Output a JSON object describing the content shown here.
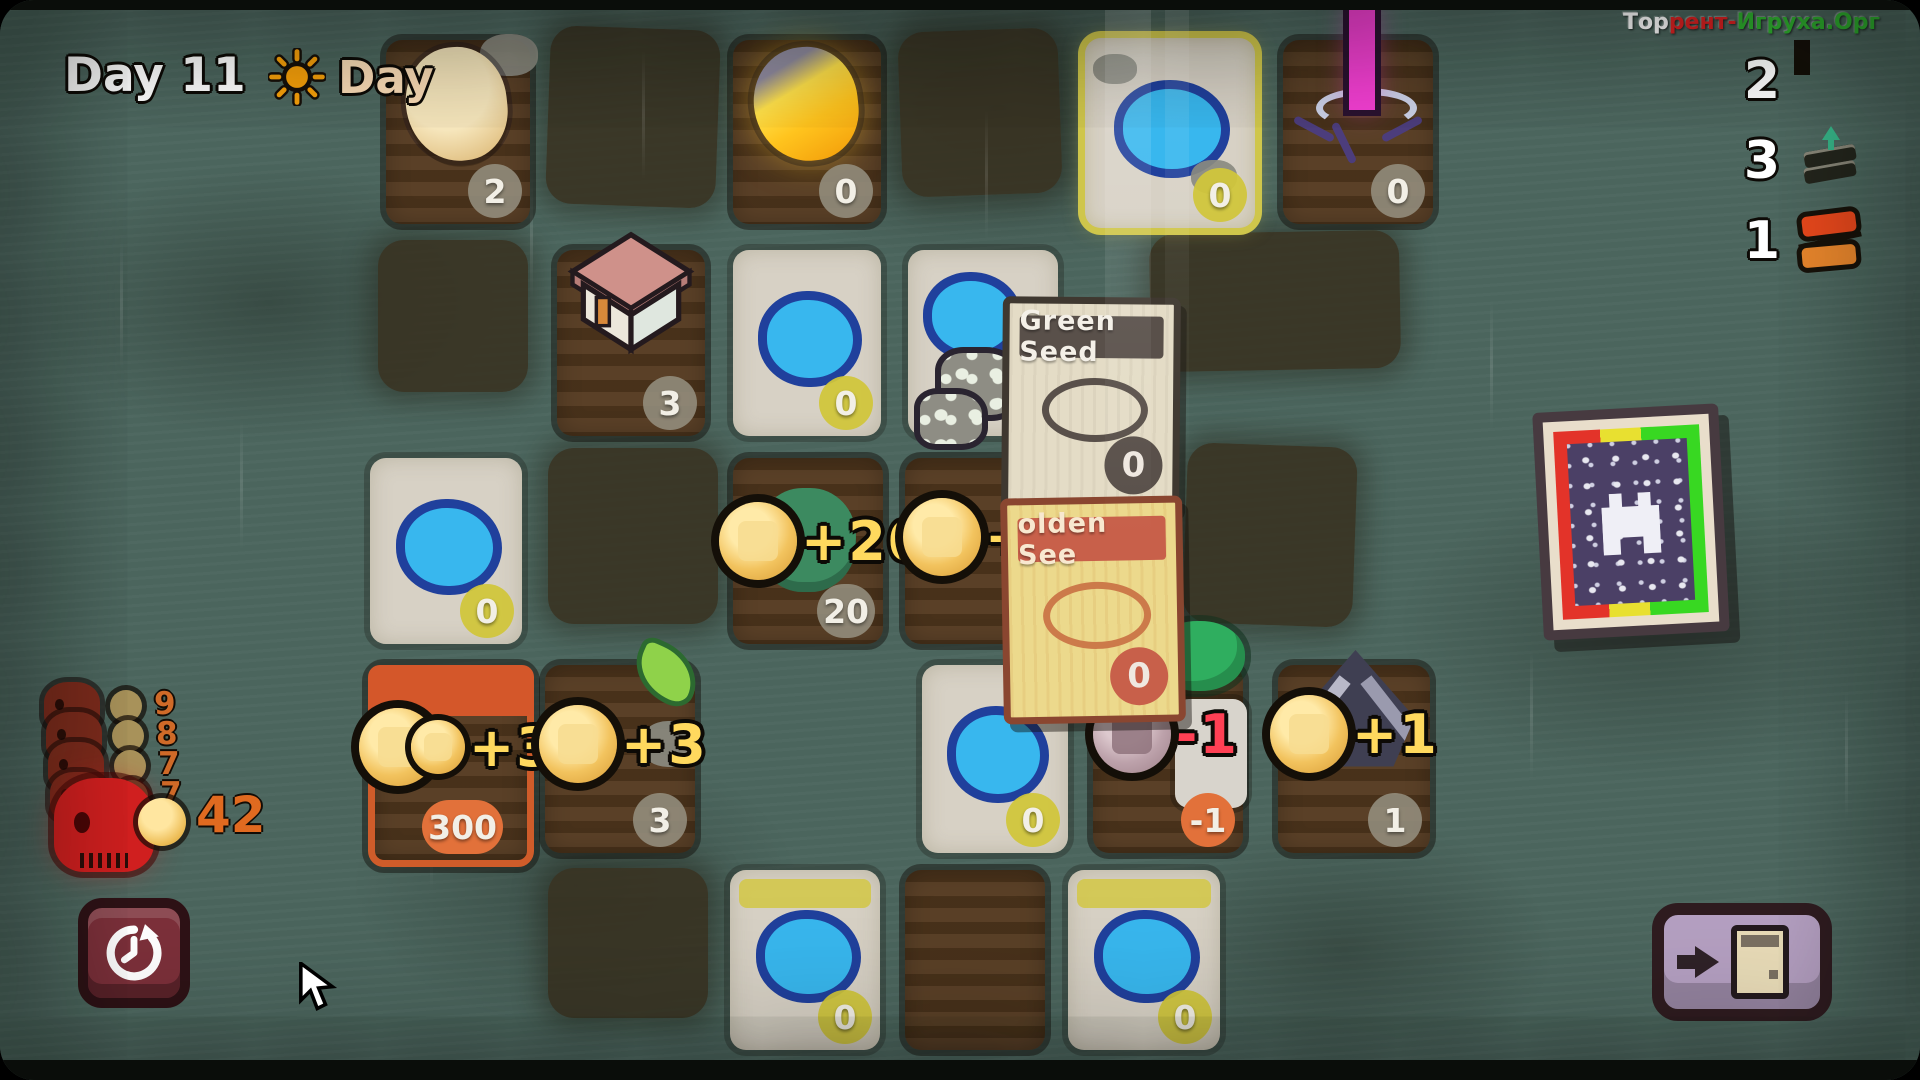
{
  "hud": {
    "day_counter": "Day 11",
    "phase": {
      "label": "Day",
      "icon": "sun-icon"
    },
    "watermark": {
      "part_white": "Тор",
      "part_red": "рент-",
      "part_green": "Игруха.Орг"
    },
    "resources": [
      {
        "name": "coins",
        "icon": "coin-icon",
        "value": "2"
      },
      {
        "name": "cards",
        "icon": "card-stack-icon",
        "value": "3"
      },
      {
        "name": "planks",
        "icon": "planks-icon",
        "value": "1"
      }
    ]
  },
  "threats": {
    "queue": [
      {
        "cost": "9"
      },
      {
        "cost": "8"
      },
      {
        "cost": "7"
      },
      {
        "cost": "7"
      }
    ],
    "current_cost": "42"
  },
  "board": {
    "tiles": [
      {
        "name": "egg-plot",
        "badge": "2"
      },
      {
        "name": "golden-egg-plot",
        "badge": "0"
      },
      {
        "name": "pond-plot-top",
        "badge": "0"
      },
      {
        "name": "wand-plot",
        "badge": "0"
      },
      {
        "name": "house-plot",
        "badge": "3"
      },
      {
        "name": "pond-plot-mid",
        "badge": "0"
      },
      {
        "name": "pond-rocks-plot"
      },
      {
        "name": "pond-plot-left",
        "badge": "0"
      },
      {
        "name": "sprout-plot",
        "badge": "20",
        "gain": "+20"
      },
      {
        "name": "seed-drop-plot",
        "gain": "+2"
      },
      {
        "name": "orange-harvest-plot",
        "badge": "300",
        "gain": "+300"
      },
      {
        "name": "small-sprout-plot",
        "badge": "3",
        "gain": "+3"
      },
      {
        "name": "pond-plot-row4",
        "badge": "0"
      },
      {
        "name": "penalty-plot",
        "badge": "-1",
        "gain": "-1"
      },
      {
        "name": "tent-plot",
        "badge": "1",
        "gain": "+1"
      },
      {
        "name": "pond-plot-bottom-left",
        "badge": "0"
      },
      {
        "name": "dirt-plot-bottom"
      },
      {
        "name": "pond-plot-bottom-right",
        "badge": "0"
      }
    ]
  },
  "cards": [
    {
      "title": "Green Seed",
      "count": "0"
    },
    {
      "title": "olden See",
      "count": "0"
    }
  ],
  "buttons": {
    "history": {
      "icon": "history-clock-icon"
    },
    "exit": {
      "icon": "exit-door-icon"
    }
  }
}
